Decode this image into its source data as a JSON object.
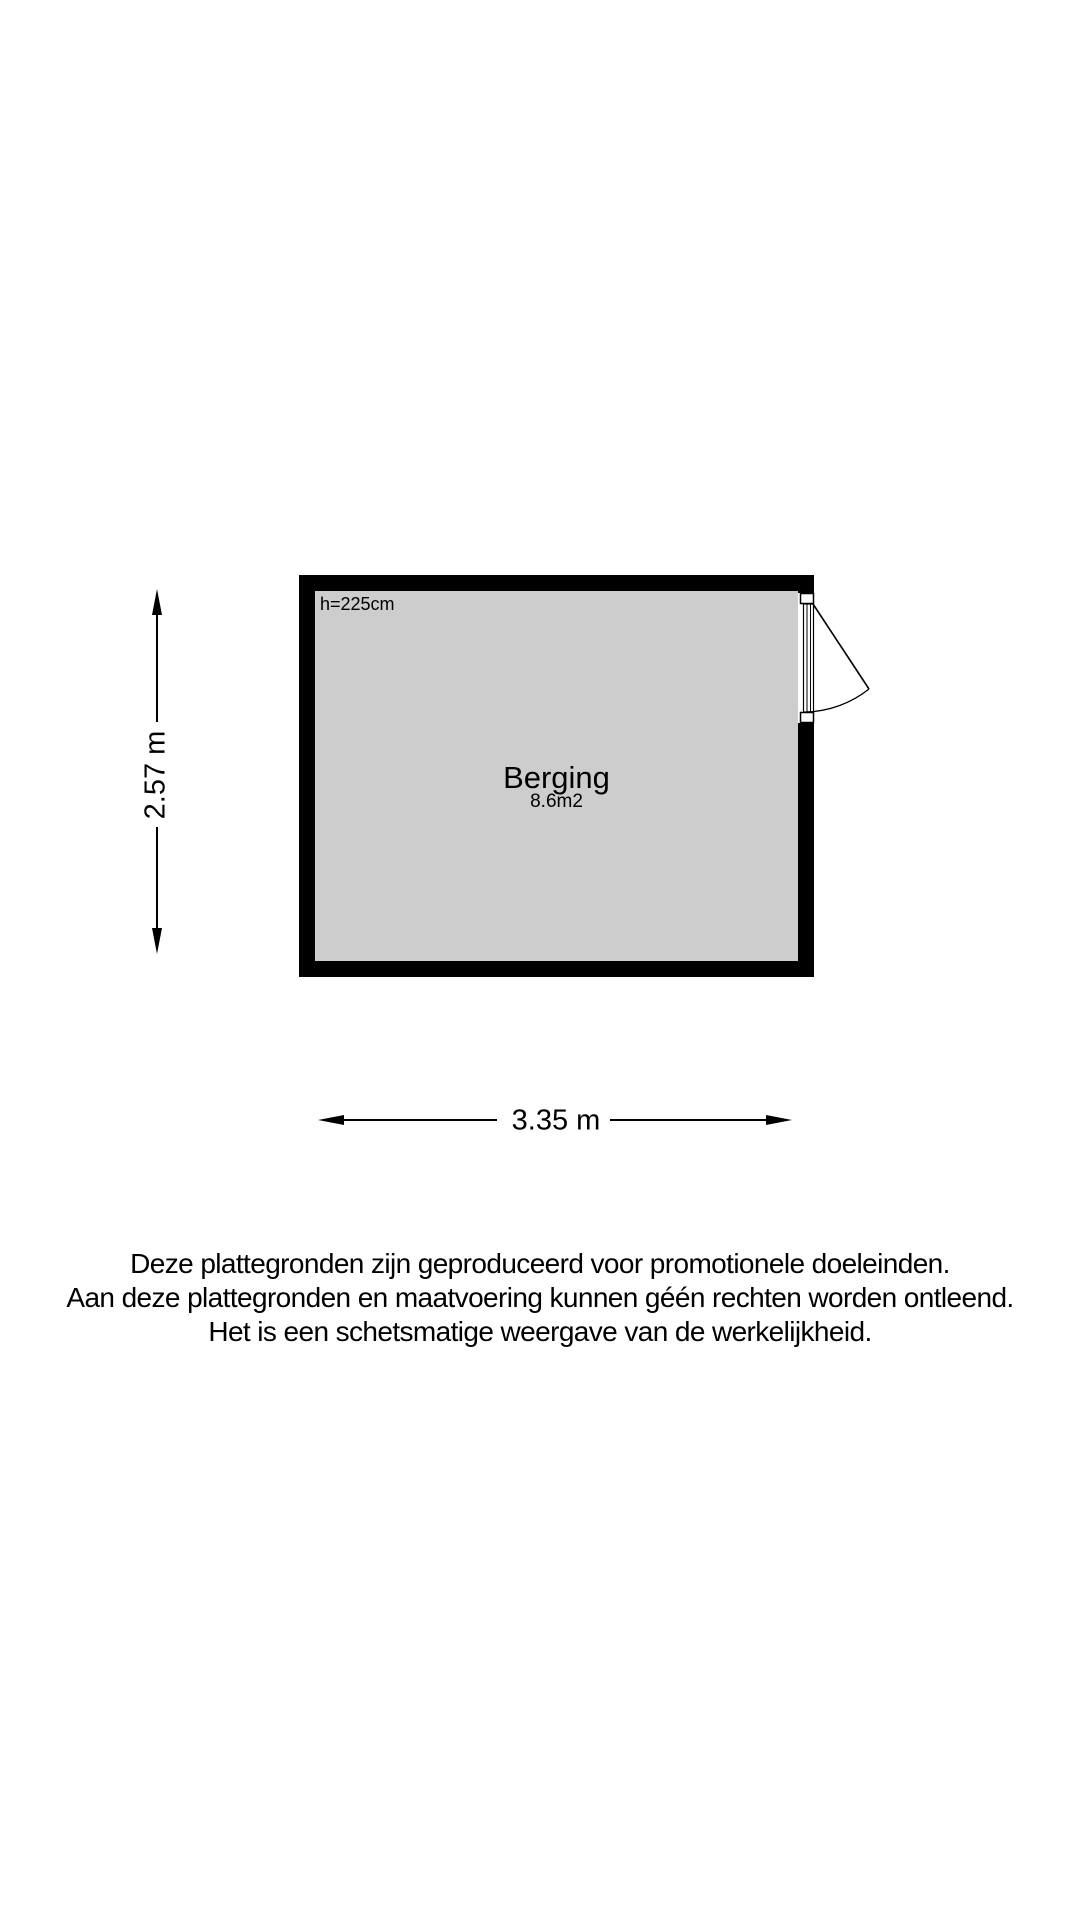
{
  "floorplan": {
    "room": {
      "name": "Berging",
      "area": "8.6m2",
      "ceiling_height": "h=225cm"
    },
    "dimensions": {
      "horizontal": "3.35 m",
      "vertical": "2.57 m"
    },
    "colors": {
      "wall": "#000000",
      "floor": "#cdcdcd",
      "line": "#000000",
      "opening": "#ffffff"
    }
  },
  "disclaimer": {
    "lines": [
      "Deze plattegronden zijn geproduceerd voor promotionele doeleinden.",
      "Aan deze plattegronden en maatvoering kunnen géén rechten worden ontleend.",
      "Het is een schetsmatige weergave van de werkelijkheid."
    ]
  }
}
